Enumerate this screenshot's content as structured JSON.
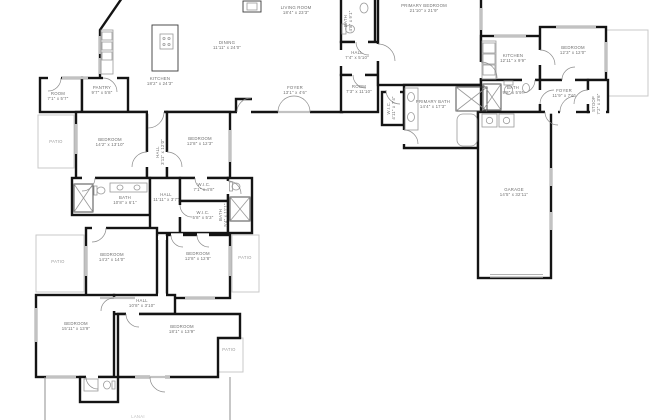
{
  "colors": {
    "wall": "#141414",
    "window": "#c2c2c2",
    "patio_outline": "#c9c9c9",
    "fixture": "#9a9a9a",
    "label_text": "#6e6e6e",
    "background": "#ffffff"
  },
  "rooms": [
    {
      "name": "LIVING ROOM",
      "dims": "18'4\" x 23'3\""
    },
    {
      "name": "DINING",
      "dims": "11'11\" x 24'0\""
    },
    {
      "name": "KITCHEN",
      "dims": "18'2\" x 24'3\""
    },
    {
      "name": "FOYER",
      "dims": "13'1\" x 4'6\""
    },
    {
      "name": "BATH",
      "dims": "4'8\" x 9'1\""
    },
    {
      "name": "HALL",
      "dims": "7'4\" x 5'10\""
    },
    {
      "name": "ROOM",
      "dims": "7'3\" x 11'10\""
    },
    {
      "name": "W.I.C.",
      "dims": "4'11\" x 7'4\""
    },
    {
      "name": "PRIMARY BEDROOM",
      "dims": "21'10\" x 21'9\""
    },
    {
      "name": "PRIMARY BATH",
      "dims": "14'4\" x 17'3\""
    },
    {
      "name": "KITCHEN",
      "dims": "12'11\" x 9'9\""
    },
    {
      "name": "BEDROOM",
      "dims": "12'3\" x 12'0\""
    },
    {
      "name": "BATH",
      "dims": "9'8\" x 5'9\""
    },
    {
      "name": "FOYER",
      "dims": "11'9\" x 7'6\""
    },
    {
      "name": "STOOP",
      "dims": "7'2\" x 3'6\""
    },
    {
      "name": "GARAGE",
      "dims": "14'5\" x 32'11\""
    },
    {
      "name": "ROOM",
      "dims": "7'1\" x 5'7\""
    },
    {
      "name": "PANTRY",
      "dims": "9'7\" x 5'8\""
    },
    {
      "name": "PATIO",
      "dims": ""
    },
    {
      "name": "BEDROOM",
      "dims": "14'2\" x 13'10\""
    },
    {
      "name": "HALL",
      "dims": "3'11\" x 12'0\""
    },
    {
      "name": "BEDROOM",
      "dims": "12'8\" x 12'3\""
    },
    {
      "name": "W.I.C.",
      "dims": "7'1\" x 4'8\""
    },
    {
      "name": "HALL",
      "dims": "11'11\" x 3'7\""
    },
    {
      "name": "BATH",
      "dims": "10'8\" x 6'1\""
    },
    {
      "name": "BATH",
      "dims": "5'4\" x 11'1\""
    },
    {
      "name": "W.I.C.",
      "dims": "5'8\" x 5'3\""
    },
    {
      "name": "PATIO",
      "dims": ""
    },
    {
      "name": "BEDROOM",
      "dims": "14'2\" x 14'0\""
    },
    {
      "name": "BEDROOM",
      "dims": "12'8\" x 12'8\""
    },
    {
      "name": "PATIO",
      "dims": ""
    },
    {
      "name": "HALL",
      "dims": "10'8\" x 3'10\""
    },
    {
      "name": "BEDROOM",
      "dims": "15'11\" x 13'9\""
    },
    {
      "name": "BEDROOM",
      "dims": "18'1\" x 13'9\""
    },
    {
      "name": "PATIO",
      "dims": ""
    },
    {
      "name": "LANAI",
      "dims": ""
    }
  ]
}
